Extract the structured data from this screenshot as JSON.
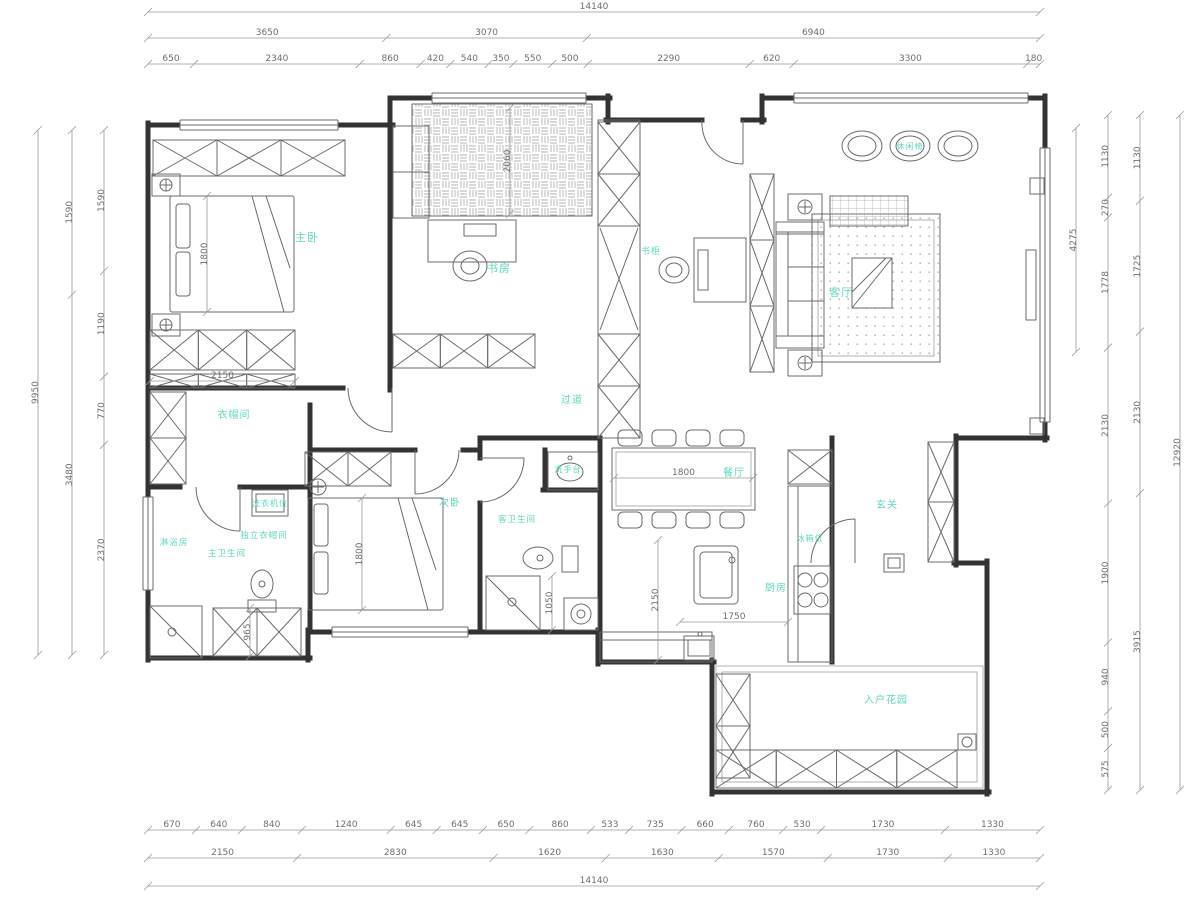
{
  "colors": {
    "wall": "#333333",
    "furniture_line": "#6b6b6b",
    "dimension_line": "#9a9a9a",
    "dimension_text": "#6f6f6f",
    "room_label": "#5ed8c0",
    "background": "#ffffff"
  },
  "dimensions": {
    "top_rows": [
      [
        "14140"
      ],
      [
        "3650",
        "3070",
        "6940"
      ],
      [
        "650",
        "2340",
        "860",
        "420",
        "540",
        "350",
        "550",
        "500",
        "2290",
        "620",
        "3300",
        "180"
      ]
    ],
    "bottom_rows": [
      [
        "670",
        "640",
        "840",
        "1240",
        "645",
        "645",
        "650",
        "860",
        "533",
        "735",
        "660",
        "760",
        "530",
        "1730",
        "1330"
      ],
      [
        "2150",
        "2830",
        "1620",
        "1630",
        "1570",
        "1730",
        "1330"
      ],
      [
        "14140"
      ]
    ],
    "left_cols": [
      [
        "9950"
      ],
      [
        "1590",
        "3480"
      ],
      [
        "1590",
        "1190",
        "770",
        "2370"
      ]
    ],
    "right_cols": [
      [
        "4275"
      ],
      [
        "1130",
        "270",
        "1778",
        "2130",
        "1900",
        "940",
        "500",
        "575"
      ],
      [
        "1130",
        "1725",
        "2130",
        "3915"
      ],
      [
        "12920"
      ]
    ],
    "interior": [
      "1800",
      "2150",
      "2060",
      "1800",
      "965",
      "1050",
      "1800",
      "2150",
      "1750"
    ]
  },
  "rooms": [
    {
      "id": "master-bedroom",
      "label": "主卧"
    },
    {
      "id": "study",
      "label": "书房"
    },
    {
      "id": "bookcase",
      "label": "书柜"
    },
    {
      "id": "living-room",
      "label": "客厅"
    },
    {
      "id": "leisure-chair",
      "label": "休闲椅"
    },
    {
      "id": "hallway",
      "label": "过道"
    },
    {
      "id": "cloakroom",
      "label": "衣帽间"
    },
    {
      "id": "laundry-spot",
      "label": "洗衣机位"
    },
    {
      "id": "walkin-closet",
      "label": "独立衣帽间"
    },
    {
      "id": "shower-room",
      "label": "淋浴房"
    },
    {
      "id": "master-bathroom",
      "label": "主卫生间"
    },
    {
      "id": "second-bedroom",
      "label": "次卧"
    },
    {
      "id": "wash-basin",
      "label": "洗手台"
    },
    {
      "id": "guest-bathroom",
      "label": "客卫生间"
    },
    {
      "id": "dining-room",
      "label": "餐厅"
    },
    {
      "id": "kitchen",
      "label": "厨房"
    },
    {
      "id": "fridge-spot",
      "label": "冰箱位"
    },
    {
      "id": "entry",
      "label": "玄关"
    },
    {
      "id": "entry-garden",
      "label": "入户花园"
    }
  ]
}
